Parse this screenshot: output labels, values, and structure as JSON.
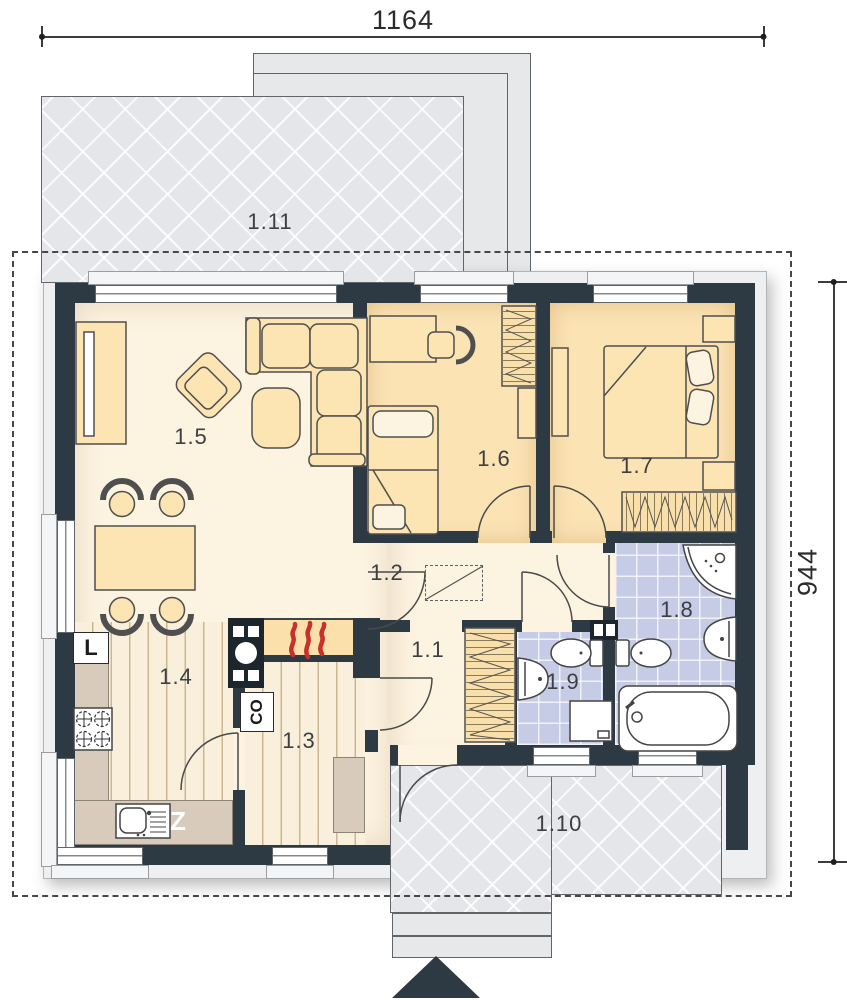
{
  "title": "single-storey-house-floor-plan",
  "dimensions": {
    "width_label": "1164",
    "height_label": "944"
  },
  "rooms": [
    {
      "label": "1.1"
    },
    {
      "label": "1.2"
    },
    {
      "label": "1.3"
    },
    {
      "label": "1.4"
    },
    {
      "label": "1.5"
    },
    {
      "label": "1.6"
    },
    {
      "label": "1.7"
    },
    {
      "label": "1.8"
    },
    {
      "label": "1.9"
    },
    {
      "label": "1.10"
    },
    {
      "label": "1.11"
    }
  ],
  "appliances": {
    "fridge": "L",
    "dishwasher": "Z",
    "boiler": "CO"
  },
  "colors": {
    "wall": "#2d3a43",
    "floor_main": "#fdf3e1",
    "floor_bedroom": "#fbe3b4",
    "floor_bath": "#c6cbe6",
    "floor_wood": "#f9efda",
    "counter": "#d8cbbb",
    "terrace": "#e4e6e9",
    "furniture": "#fce4b3",
    "flame": "#c9302c"
  }
}
